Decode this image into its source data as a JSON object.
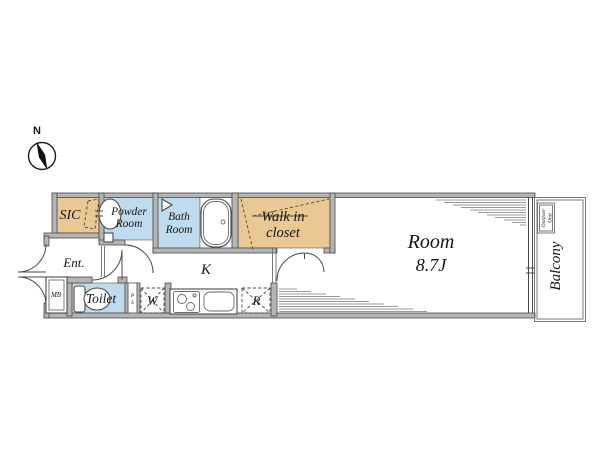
{
  "compass": {
    "north_label": "N"
  },
  "rooms": {
    "sic": "SIC",
    "powder": [
      "Powder",
      "Room"
    ],
    "bath": [
      "Bath",
      "Room"
    ],
    "walk_in_closet": [
      "Walk in",
      "closet"
    ],
    "main_room": [
      "Room",
      "8.7J"
    ],
    "kitchen": "K",
    "entrance": "Ent.",
    "toilet": "Toilet",
    "balcony": "Balcony",
    "outdoor_unit": [
      "Outdoor",
      "Unit"
    ],
    "meter_box": "MB",
    "pipe_space": [
      "P",
      "S"
    ],
    "washer": "W",
    "refrigerator": "R"
  },
  "colors": {
    "closet_tan": "#eac893",
    "wet_area_blue": "#bedced",
    "wall_gray": "#b5b5b5",
    "line_dark": "#4a4a4a"
  }
}
